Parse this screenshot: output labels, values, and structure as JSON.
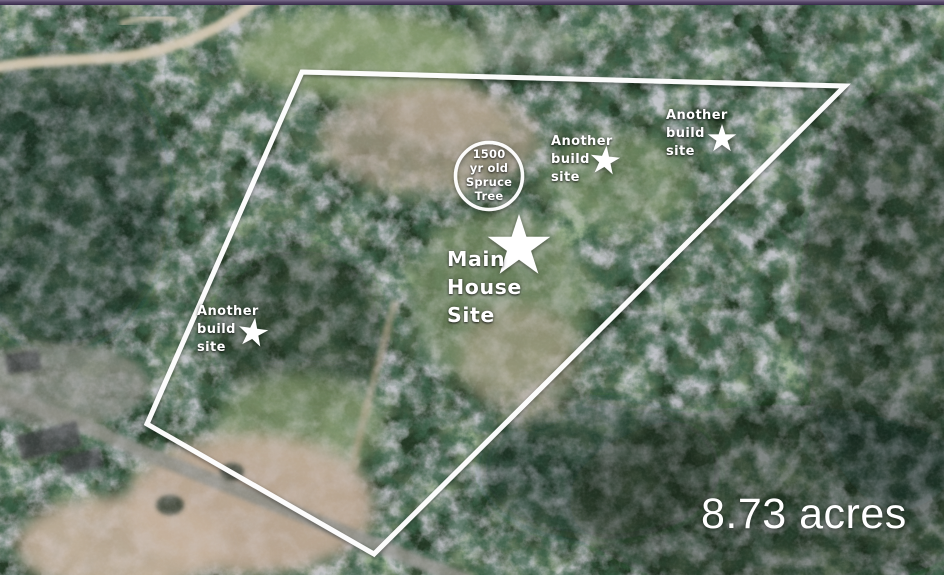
{
  "map": {
    "acreage": "8.73 acres",
    "labels": {
      "spruce_tree": {
        "lines": [
          "1500",
          "yr old",
          "Spruce",
          "Tree"
        ]
      },
      "main_house_site": {
        "lines": [
          "Main",
          "House",
          "Site"
        ]
      },
      "build_site_left": {
        "lines": [
          "Another",
          "build",
          "site"
        ]
      },
      "build_site_middle": {
        "lines": [
          "Another",
          "build",
          "site"
        ]
      },
      "build_site_right": {
        "lines": [
          "Another",
          "build",
          "site"
        ]
      }
    },
    "markers": {
      "star_count": 4,
      "main_house_star": "large-white-star",
      "build_site_stars": "small-white-star"
    },
    "colors": {
      "annotation_white": "#ffffff",
      "top_bar_purple": "#453a56",
      "forest_green": "#233824",
      "clearing_tan": "#b9a68f",
      "road_grey": "#8e8e86"
    }
  }
}
